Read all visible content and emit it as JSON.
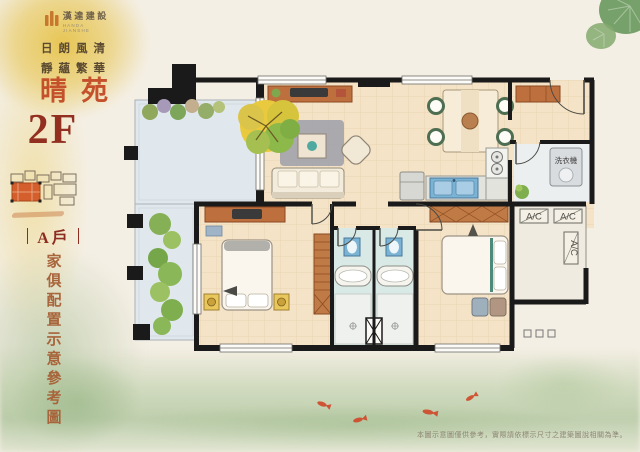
{
  "colors": {
    "paper": "#f4efe4",
    "blob_yellow": "#e6c248",
    "wash_green": "#94b582",
    "accent_orange": "#c4512c",
    "dark_red": "#8c2d20",
    "caption_brown": "#a8643a",
    "wall_black": "#1a1a1a",
    "wood_furniture": "#bd6f3e",
    "floor_tan": "#f4e3c7",
    "bath_teal": "#d9e9e6",
    "balcony_blue": "#e0e8ee",
    "koi_red": "#cf4728"
  },
  "branding": {
    "logo_text": "漢達建設",
    "logo_subtext": "HANDA JIANSHE",
    "tagline_line1": "日朗風清",
    "tagline_line2": "靜蘊繁華",
    "project_name": "晴苑"
  },
  "sidebar": {
    "floor_label": "2F",
    "unit_label": "A戶",
    "caption": "家俱配置示意參考圖"
  },
  "plan": {
    "labels": {
      "washing_machine": "洗衣機",
      "ac_1": "A/C",
      "ac_2": "A/C",
      "ac_3": "A/C"
    }
  },
  "footer": {
    "disclaimer": "本圖示意圖僅供參考，實際請依標示尺寸之建築圖說相關為準。"
  }
}
